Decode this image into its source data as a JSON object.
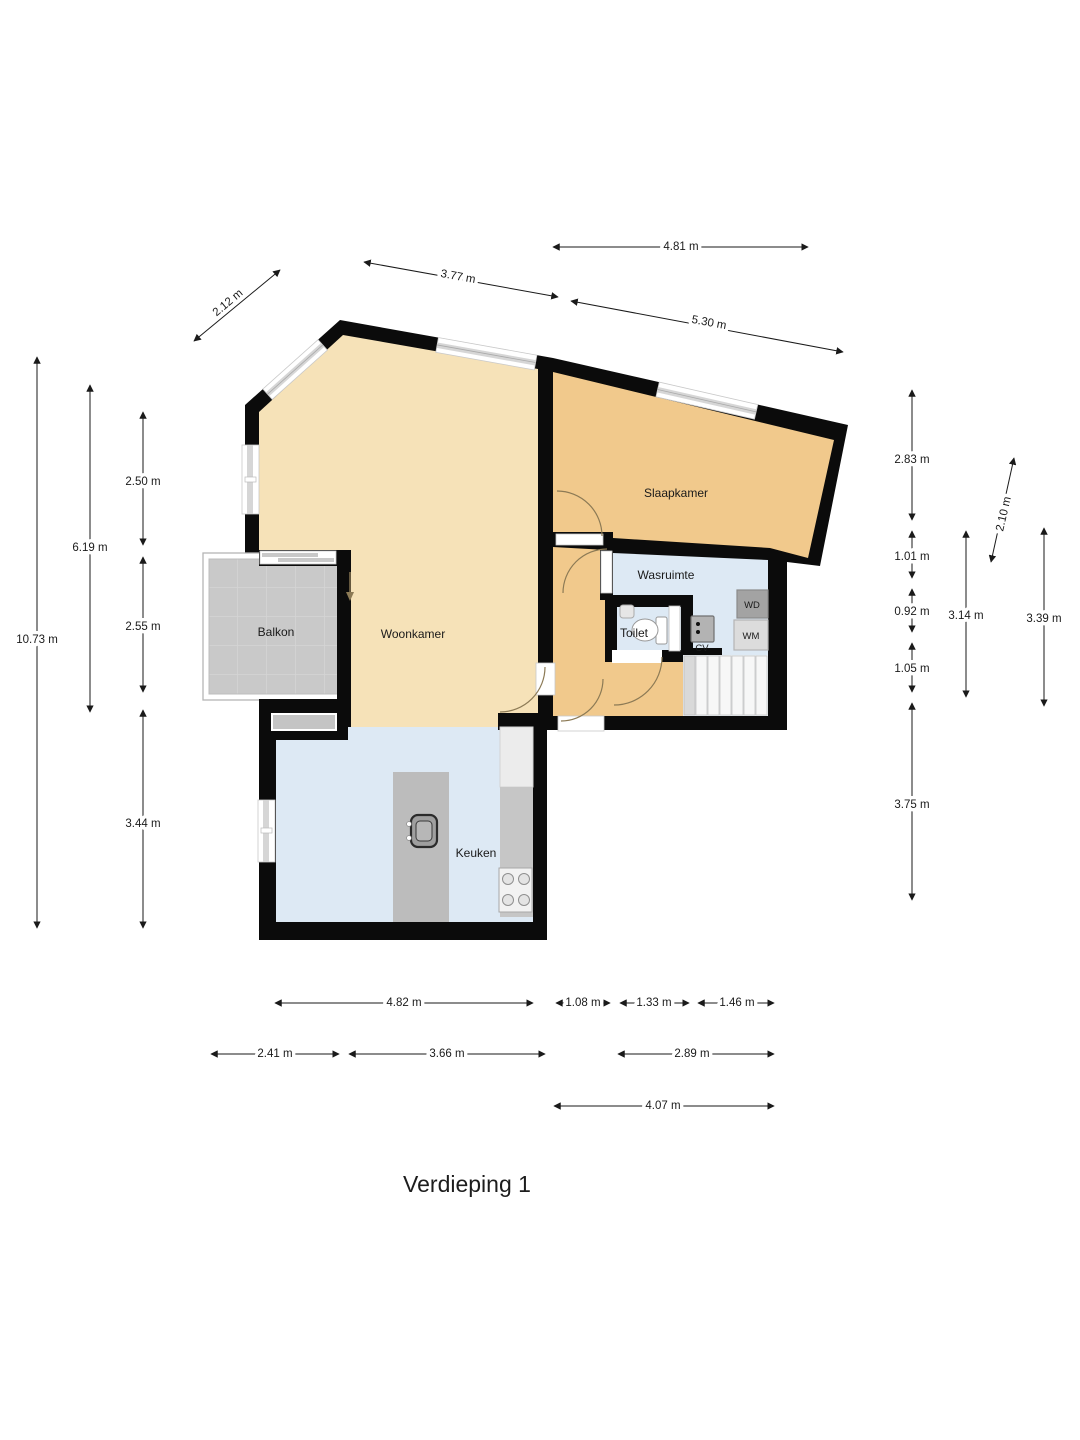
{
  "title": "Verdieping 1",
  "colors": {
    "wall": "#0b0b0b",
    "woonkamer_floor": "#f6e2b8",
    "slaapkamer_floor": "#f1c98c",
    "wet_room_floor": "#dde9f4",
    "balcony_floor": "#c9c9c9",
    "counter_gray": "#c6c6c6"
  },
  "floorplan": {
    "room_labels": [
      {
        "id": "balkon",
        "label": "Balkon",
        "x": 276,
        "y": 636
      },
      {
        "id": "woonkamer",
        "label": "Woonkamer",
        "x": 413,
        "y": 638
      },
      {
        "id": "slaapkamer",
        "label": "Slaapkamer",
        "x": 676,
        "y": 497
      },
      {
        "id": "wasruimte",
        "label": "Wasruimte",
        "x": 666,
        "y": 579
      },
      {
        "id": "toilet",
        "label": "Toilet",
        "x": 634,
        "y": 637
      },
      {
        "id": "keuken",
        "label": "Keuken",
        "x": 476,
        "y": 857
      }
    ],
    "appliance_labels": [
      {
        "id": "wd",
        "label": "WD",
        "x": 752,
        "y": 608
      },
      {
        "id": "wm",
        "label": "WM",
        "x": 751,
        "y": 639
      },
      {
        "id": "cv",
        "label": "CV",
        "x": 702,
        "y": 651
      }
    ],
    "dimensions": [
      {
        "label": "2.12 m",
        "x1": 194,
        "y1": 341,
        "x2": 280,
        "y2": 270,
        "lx": 228,
        "ly": 303,
        "rot": -40
      },
      {
        "label": "3.77 m",
        "x1": 364,
        "y1": 262,
        "x2": 558,
        "y2": 297,
        "lx": 458,
        "ly": 277,
        "rot": 10
      },
      {
        "label": "4.81 m",
        "x1": 553,
        "y1": 247,
        "x2": 808,
        "y2": 247,
        "lx": 681,
        "ly": 247,
        "rot": 0
      },
      {
        "label": "5.30 m",
        "x1": 571,
        "y1": 301,
        "x2": 843,
        "y2": 352,
        "lx": 709,
        "ly": 323,
        "rot": 10.5
      },
      {
        "label": "10.73 m",
        "x1": 37,
        "y1": 357,
        "x2": 37,
        "y2": 928,
        "lx": 37,
        "ly": 640,
        "rot": 0
      },
      {
        "label": "6.19 m",
        "x1": 90,
        "y1": 385,
        "x2": 90,
        "y2": 712,
        "lx": 90,
        "ly": 548,
        "rot": 0
      },
      {
        "label": "2.50 m",
        "x1": 143,
        "y1": 412,
        "x2": 143,
        "y2": 545,
        "lx": 143,
        "ly": 482,
        "rot": 0
      },
      {
        "label": "2.55 m",
        "x1": 143,
        "y1": 557,
        "x2": 143,
        "y2": 692,
        "lx": 143,
        "ly": 627,
        "rot": 0
      },
      {
        "label": "3.44 m",
        "x1": 143,
        "y1": 710,
        "x2": 143,
        "y2": 928,
        "lx": 143,
        "ly": 824,
        "rot": 0
      },
      {
        "label": "2.83 m",
        "x1": 912,
        "y1": 390,
        "x2": 912,
        "y2": 520,
        "lx": 912,
        "ly": 460,
        "rot": 0
      },
      {
        "label": "1.01 m",
        "x1": 912,
        "y1": 531,
        "x2": 912,
        "y2": 578,
        "lx": 912,
        "ly": 557,
        "rot": 0
      },
      {
        "label": "0.92 m",
        "x1": 912,
        "y1": 589,
        "x2": 912,
        "y2": 632,
        "lx": 912,
        "ly": 612,
        "rot": 0
      },
      {
        "label": "1.05 m",
        "x1": 912,
        "y1": 643,
        "x2": 912,
        "y2": 692,
        "lx": 912,
        "ly": 669,
        "rot": 0
      },
      {
        "label": "3.75 m",
        "x1": 912,
        "y1": 703,
        "x2": 912,
        "y2": 900,
        "lx": 912,
        "ly": 805,
        "rot": 0
      },
      {
        "label": "3.14 m",
        "x1": 966,
        "y1": 531,
        "x2": 966,
        "y2": 697,
        "lx": 966,
        "ly": 616,
        "rot": 0
      },
      {
        "label": "3.39 m",
        "x1": 1044,
        "y1": 528,
        "x2": 1044,
        "y2": 706,
        "lx": 1044,
        "ly": 619,
        "rot": 0
      },
      {
        "label": "2.10 m",
        "x1": 991,
        "y1": 562,
        "x2": 1014,
        "y2": 458,
        "lx": 1004,
        "ly": 514,
        "rot": -77
      },
      {
        "label": "4.82 m",
        "x1": 275,
        "y1": 1003,
        "x2": 533,
        "y2": 1003,
        "lx": 404,
        "ly": 1003,
        "rot": 0
      },
      {
        "label": "1.08 m",
        "x1": 556,
        "y1": 1003,
        "x2": 610,
        "y2": 1003,
        "lx": 583,
        "ly": 1003,
        "rot": 0
      },
      {
        "label": "1.33 m",
        "x1": 620,
        "y1": 1003,
        "x2": 689,
        "y2": 1003,
        "lx": 654,
        "ly": 1003,
        "rot": 0
      },
      {
        "label": "1.46 m",
        "x1": 698,
        "y1": 1003,
        "x2": 774,
        "y2": 1003,
        "lx": 737,
        "ly": 1003,
        "rot": 0
      },
      {
        "label": "2.41 m",
        "x1": 211,
        "y1": 1054,
        "x2": 339,
        "y2": 1054,
        "lx": 275,
        "ly": 1054,
        "rot": 0
      },
      {
        "label": "3.66 m",
        "x1": 349,
        "y1": 1054,
        "x2": 545,
        "y2": 1054,
        "lx": 447,
        "ly": 1054,
        "rot": 0
      },
      {
        "label": "2.89 m",
        "x1": 618,
        "y1": 1054,
        "x2": 774,
        "y2": 1054,
        "lx": 692,
        "ly": 1054,
        "rot": 0
      },
      {
        "label": "4.07 m",
        "x1": 554,
        "y1": 1106,
        "x2": 774,
        "y2": 1106,
        "lx": 663,
        "ly": 1106,
        "rot": 0
      }
    ]
  }
}
